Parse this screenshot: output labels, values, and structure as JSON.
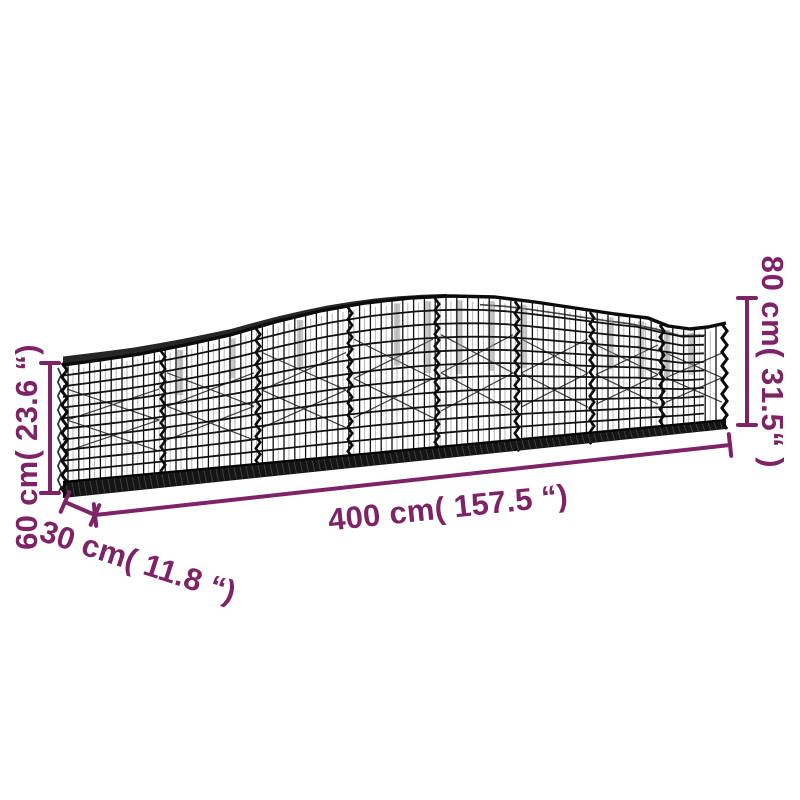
{
  "background_color": "#ffffff",
  "accent_color": "#7d2366",
  "mesh_color": "#111111",
  "illustration": {
    "subject": "arched gabion wire mesh basket"
  },
  "dimension_labels": {
    "length": "400 cm( 157.5 “)",
    "depth": "30 cm( 11.8 “)",
    "height_left": "60 cm( 23.6 “)",
    "height_right": "80 cm( 31.5“ )"
  }
}
